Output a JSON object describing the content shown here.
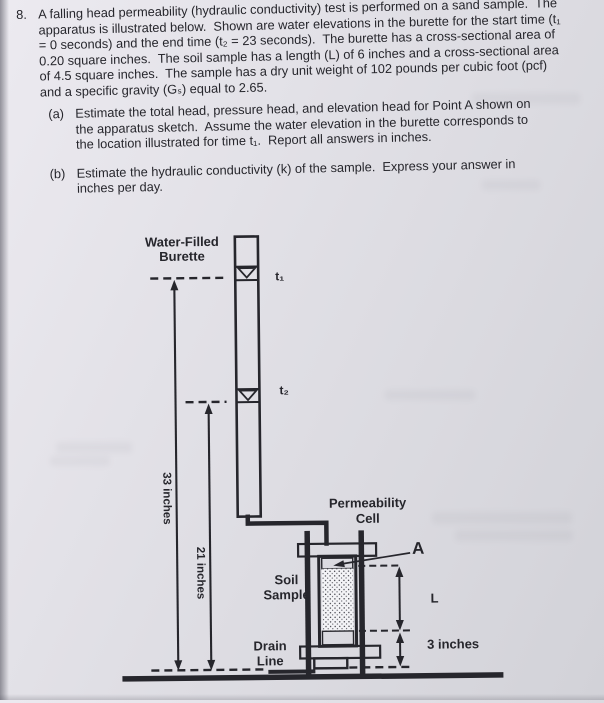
{
  "problem": {
    "number": "8.",
    "lines": [
      "A falling head permeability (hydraulic conductivity) test is performed on a sand sample.  The",
      "apparatus is illustrated below.  Shown are water elevations in the burette for the start time (t₁",
      "= 0 seconds) and the end time (t₂ = 23 seconds).  The burette has a cross-sectional area of",
      "0.20 square inches.  The soil sample has a length (L) of 6 inches and a cross-sectional area",
      "of 4.5 square inches.  The sample has a dry unit weight of 102 pounds per cubic foot (pcf)",
      "and a specific gravity (Gₛ) equal to 2.65."
    ],
    "parts": [
      {
        "label": "(a)",
        "lines": [
          "Estimate the total head, pressure head, and elevation head for Point A shown on",
          "the apparatus sketch.  Assume the water elevation in the burette corresponds to",
          "the location illustrated for time t₁.  Report all answers in inches."
        ]
      },
      {
        "label": "(b)",
        "lines": [
          "Estimate the hydraulic conductivity (k) of the sample.  Express your answer in",
          "inches per day."
        ]
      }
    ]
  },
  "diagram": {
    "labels": {
      "burette": [
        "Water-Filled",
        "Burette"
      ],
      "t1": "t₁",
      "t2": "t₂",
      "dim_33": "33 inches",
      "dim_21": "21 inches",
      "cell": [
        "Permeability",
        "Cell"
      ],
      "soil": [
        "Soil",
        "Sample"
      ],
      "drain": [
        "Drain",
        "Line"
      ],
      "point_a": "A",
      "length": "L",
      "dim_3": "3 inches"
    }
  },
  "colors": {
    "ink": "#26262c",
    "paper": "#dfdee4",
    "cap_gray": "#9ba1a5"
  }
}
